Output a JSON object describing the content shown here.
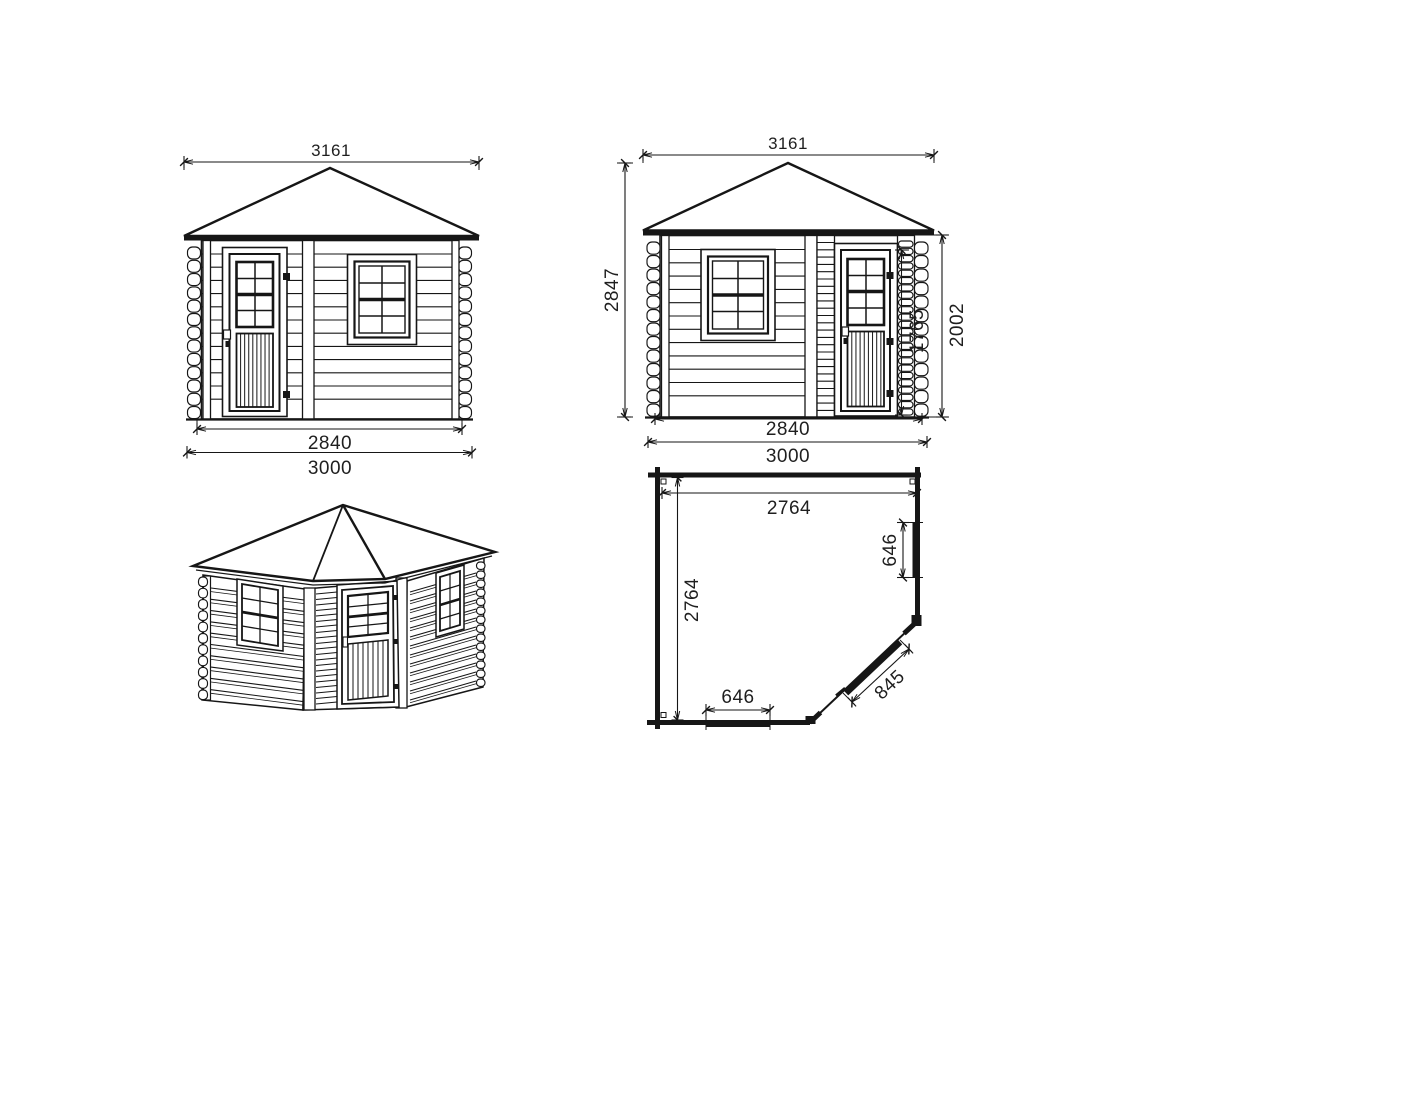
{
  "page": {
    "background": "#ffffff",
    "line_color": "#161616"
  },
  "views": {
    "front_elevation": {
      "name": "front-elevation",
      "dims": {
        "roof_width": "3161",
        "wall_width": "2840",
        "overall_width": "3000"
      }
    },
    "side_elevation": {
      "name": "side-elevation",
      "dims": {
        "roof_width": "3161",
        "overall_height": "2847",
        "door_height": "1765",
        "wall_height": "2002",
        "wall_width": "2840",
        "overall_width": "3000"
      }
    },
    "perspective_view": {
      "name": "3d-perspective-view"
    },
    "floor_plan": {
      "name": "floor-plan",
      "dims": {
        "interior_width": "2764",
        "interior_depth": "2764",
        "side_window_width": "646",
        "front_window_width": "646",
        "door_width": "845"
      }
    }
  }
}
